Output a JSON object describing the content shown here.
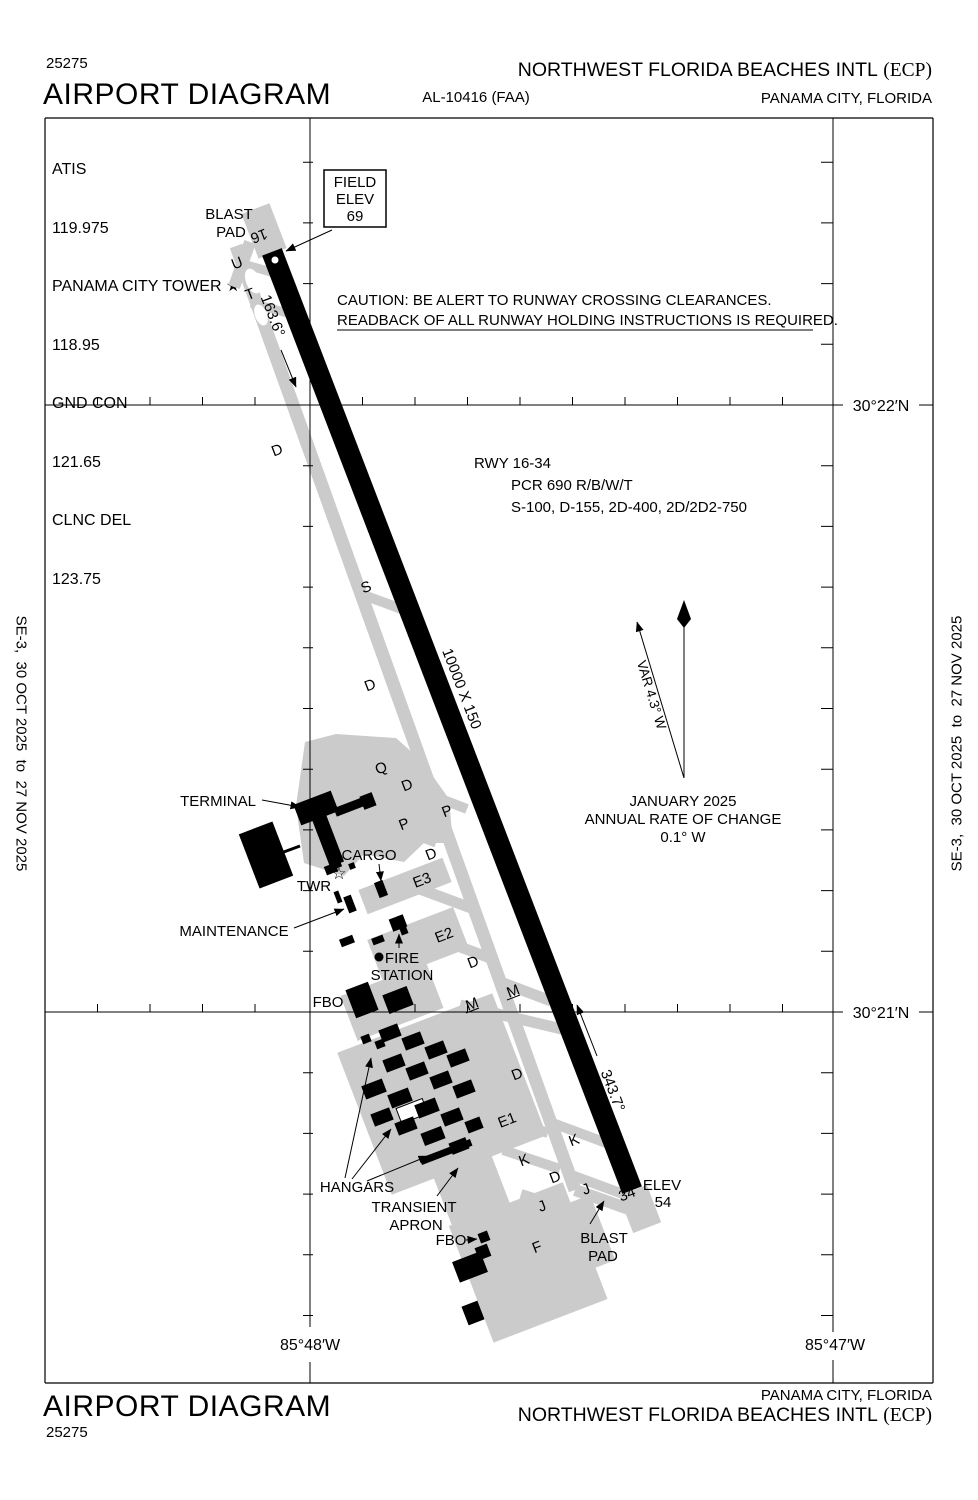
{
  "header": {
    "chart_code": "25275",
    "title": "AIRPORT DIAGRAM",
    "al_number": "AL-10416 (FAA)",
    "airport_name": "NORTHWEST FLORIDA BEACHES INTL",
    "airport_icao": "(ECP)",
    "city": "PANAMA CITY, FLORIDA"
  },
  "footer": {
    "title": "AIRPORT DIAGRAM",
    "chart_code": "25275",
    "airport_name": "NORTHWEST FLORIDA BEACHES INTL",
    "airport_icao": "(ECP)",
    "city": "PANAMA CITY, FLORIDA"
  },
  "edition": {
    "left": "SE-3,  30 OCT 2025  to  27 NOV 2025",
    "right": "SE-3,  30 OCT 2025  to  27 NOV 2025"
  },
  "frequencies": [
    {
      "label": "ATIS",
      "value": "119.975"
    },
    {
      "label": "PANAMA CITY TOWER ★",
      "value": "118.95"
    },
    {
      "label": "GND CON",
      "value": "121.65"
    },
    {
      "label": "CLNC DEL",
      "value": "123.75"
    }
  ],
  "field_elev_box": {
    "line1": "FIELD",
    "line2": "ELEV",
    "value": "69"
  },
  "caution": {
    "line1": "CAUTION: BE ALERT TO RUNWAY CROSSING CLEARANCES.",
    "line2": "READBACK OF ALL RUNWAY HOLDING INSTRUCTIONS IS REQUIRED."
  },
  "runway_info": {
    "line1": "RWY 16-34",
    "line2": "PCR 690 R/B/W/T",
    "line3": "S-100, D-155, 2D-400, 2D/2D2-750"
  },
  "runway": {
    "number_north": "16",
    "number_south": "34",
    "dimensions": "10000 X 150",
    "heading_north": "163.6°",
    "heading_south": "343.7°"
  },
  "elevations": {
    "rwy34_label": "ELEV",
    "rwy34_value": "54"
  },
  "compass": {
    "variation": "VAR 4.3° W",
    "date": "JANUARY 2025",
    "rate_label": "ANNUAL RATE OF CHANGE",
    "rate_value": "0.1° W"
  },
  "grid": {
    "lat_north": "30°22′N",
    "lat_south": "30°21′N",
    "lon_west": "85°48′W",
    "lon_east": "85°47′W"
  },
  "map_labels": {
    "blast_pad_north": {
      "line1": "BLAST",
      "line2": "PAD"
    },
    "blast_pad_south": {
      "line1": "BLAST",
      "line2": "PAD"
    },
    "terminal": "TERMINAL",
    "twr": "TWR",
    "twr_star": "☆",
    "cargo": "CARGO",
    "maintenance": "MAINTENANCE",
    "fire_station": {
      "line1": "FIRE",
      "line2": "STATION"
    },
    "fbo_north": "FBO",
    "fbo_south": "FBO",
    "hangars": "HANGARS",
    "transient_apron": {
      "line1": "TRANSIENT",
      "line2": "APRON"
    }
  },
  "taxiway_labels": [
    "U",
    "T",
    "D",
    "S",
    "D",
    "Q",
    "D",
    "P",
    "P",
    "D",
    "E3",
    "E2",
    "D",
    "M",
    "M",
    "D",
    "E1",
    "K",
    "K",
    "D",
    "J",
    "J",
    "F"
  ],
  "colors": {
    "ink": "#000000",
    "apron_gray": "#cbcbcb",
    "paper": "#ffffff"
  }
}
